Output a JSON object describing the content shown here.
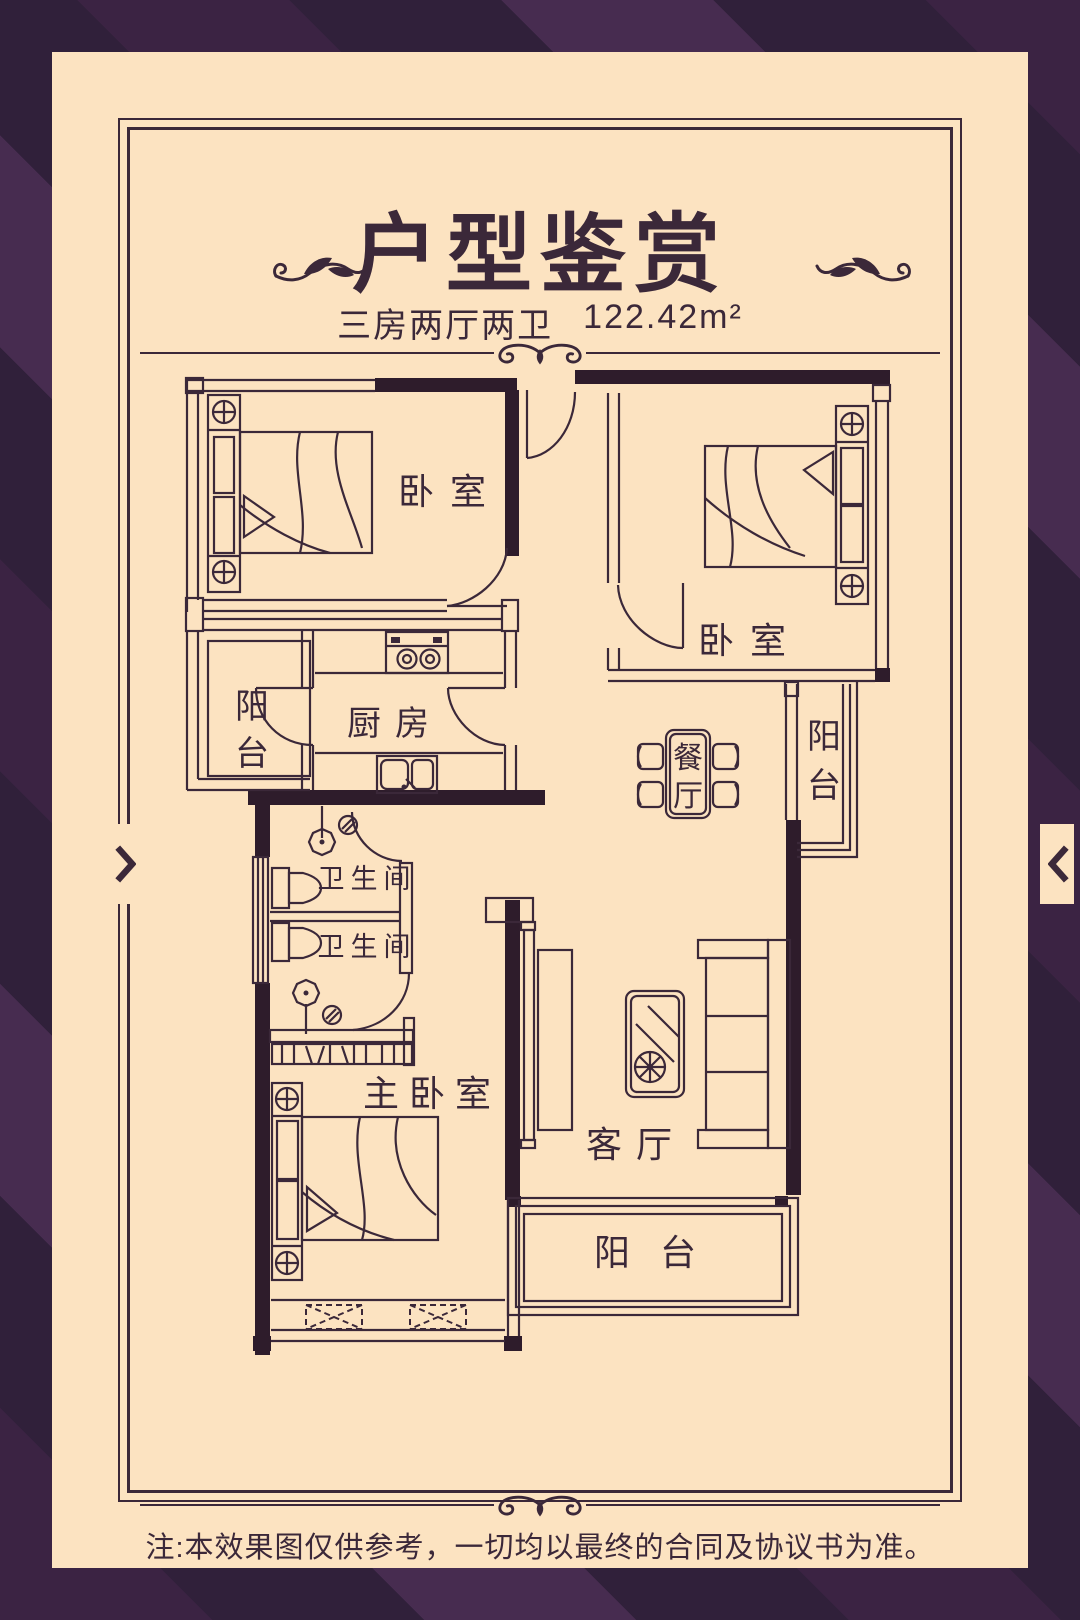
{
  "colors": {
    "bg_dark": "#30203a",
    "bg_mid": "#3b2343",
    "bg_light": "#472c50",
    "poster_bg": "#fce3c1",
    "ink": "#3b2839",
    "wall": "#2e1c2b"
  },
  "header": {
    "title": "户型鉴赏",
    "layout_label": "三房两厅两卫",
    "area_label": "122.42m²"
  },
  "floorplan": {
    "rooms": {
      "bedroom_a": {
        "label": "卧室"
      },
      "bedroom_b": {
        "label": "卧室"
      },
      "kitchen": {
        "label": "厨房"
      },
      "balcony_left": {
        "label": "阳台"
      },
      "dining": {
        "label": "餐厅"
      },
      "balcony_right": {
        "label": "阳台"
      },
      "bathroom_upper": {
        "label": "卫生间"
      },
      "bathroom_lower": {
        "label": "卫生间"
      },
      "master_bedroom": {
        "label": "主卧室"
      },
      "living_room": {
        "label": "客厅"
      },
      "balcony_bottom": {
        "label": "阳台"
      }
    }
  },
  "footer": {
    "note": "注:本效果图仅供参考，一切均以最终的合同及协议书为准。"
  }
}
